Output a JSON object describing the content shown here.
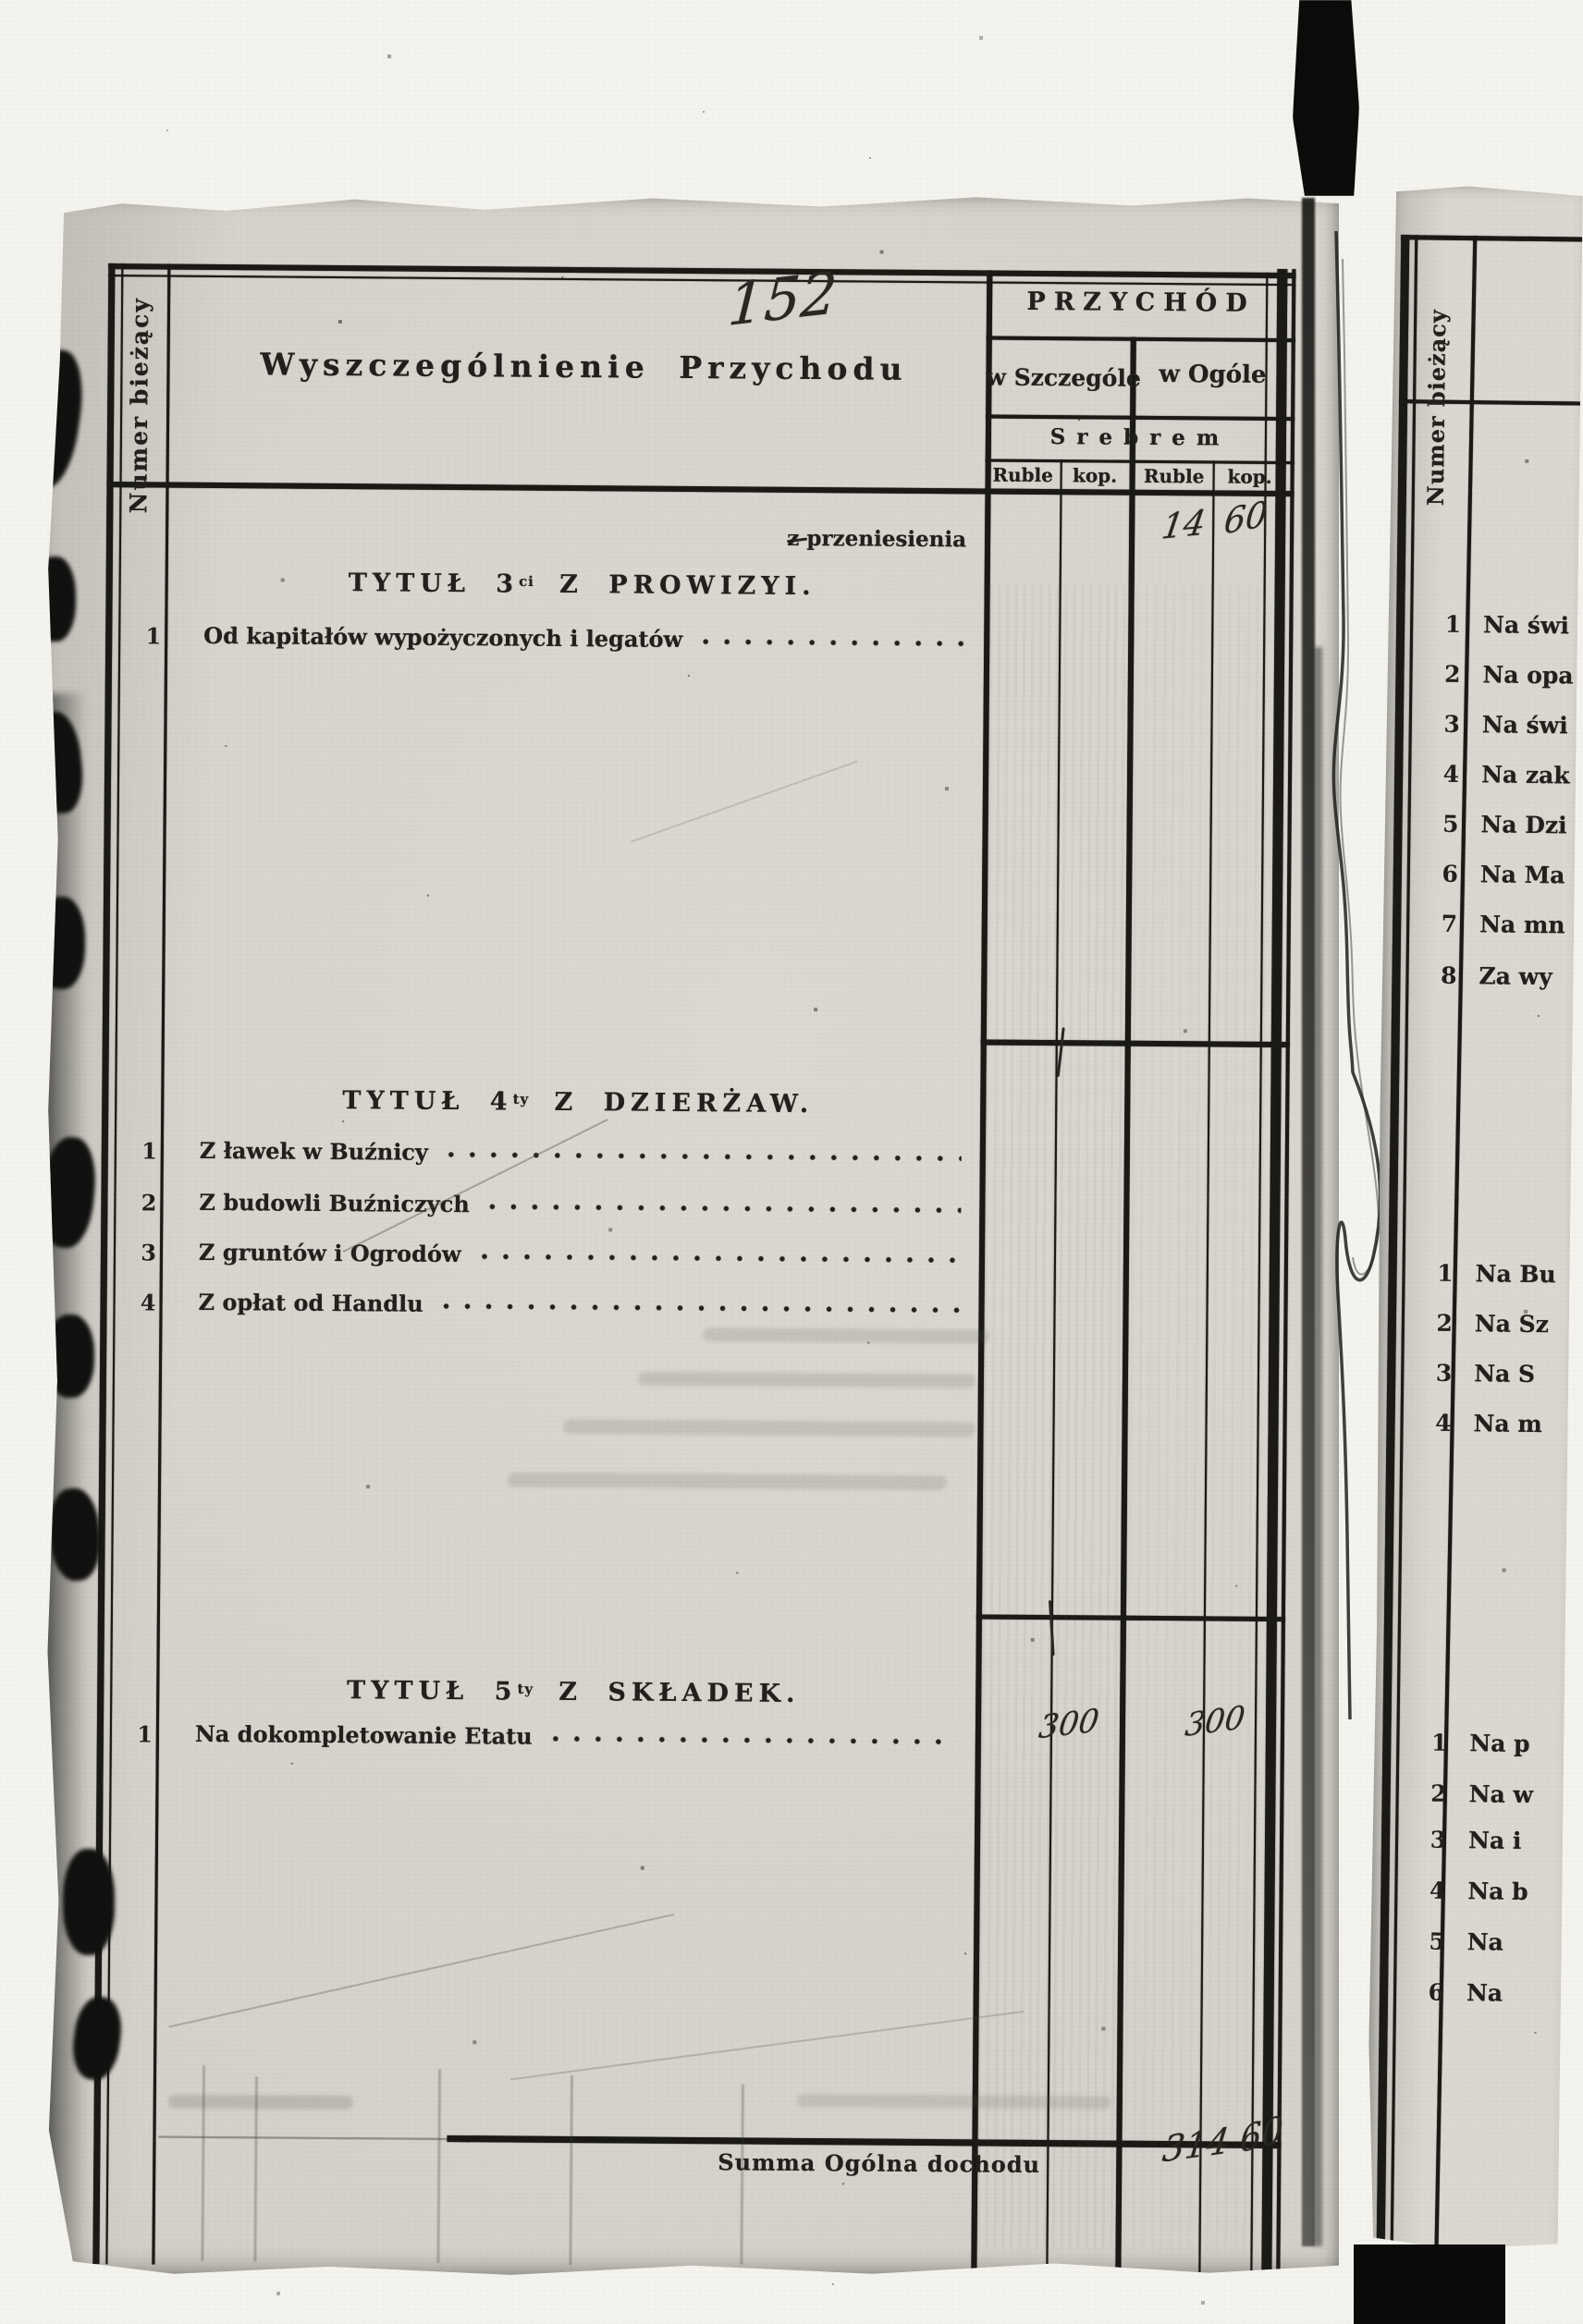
{
  "folio_handwritten": "152",
  "left_page": {
    "row_number_column_label": "Numer bieżący",
    "description_header": "Wyszczególnienie Przychodu",
    "income_header": "PRZYCHÓD",
    "col_in_detail": "w Szczególe",
    "col_in_total": "w Ogóle",
    "currency_row": "Srebrem",
    "units": [
      "Ruble",
      "kop.",
      "Ruble",
      "kop."
    ],
    "carryover_label": "z przeniesienia",
    "carryover_total_ruble": "14",
    "carryover_total_kop": "60",
    "sections": [
      {
        "title_prefix": "TYTUŁ 3",
        "title_sup": "ci",
        "title_rest": "Z PROWIZYI.",
        "items": [
          {
            "num": "1",
            "label": "Od kapitałów wypożyczonych i legatów"
          }
        ]
      },
      {
        "title_prefix": "TYTUŁ 4",
        "title_sup": "ty",
        "title_rest": "Z DZIERŻAW.",
        "items": [
          {
            "num": "1",
            "label": "Z ławek w Buźnicy"
          },
          {
            "num": "2",
            "label": "Z budowli Buźniczych"
          },
          {
            "num": "3",
            "label": "Z gruntów i Ogrodów"
          },
          {
            "num": "4",
            "label": "Z opłat od Handlu"
          }
        ]
      },
      {
        "title_prefix": "TYTUŁ 5",
        "title_sup": "ty",
        "title_rest": "Z SKŁADEK.",
        "items": [
          {
            "num": "1",
            "label": "Na dokompletowanie Etatu",
            "detail_ruble": "300",
            "total_ruble": "300"
          }
        ]
      }
    ],
    "summary_label": "Summa Ogólna dochodu",
    "summary_total_ruble": "314",
    "summary_total_kop": "60"
  },
  "right_page": {
    "row_number_column_label": "Numer bieżący",
    "groups": [
      {
        "items": [
          {
            "num": "1",
            "label": "Na świ"
          },
          {
            "num": "2",
            "label": "Na opa"
          },
          {
            "num": "3",
            "label": "Na świ"
          },
          {
            "num": "4",
            "label": "Na zak"
          },
          {
            "num": "5",
            "label": "Na Dzi"
          },
          {
            "num": "6",
            "label": "Na Ma"
          },
          {
            "num": "7",
            "label": "Na mn"
          },
          {
            "num": "8",
            "label": "Za wy"
          }
        ]
      },
      {
        "items": [
          {
            "num": "1",
            "label": "Na Bu"
          },
          {
            "num": "2",
            "label": "Na Sz"
          },
          {
            "num": "3",
            "label": "Na S"
          },
          {
            "num": "4",
            "label": "Na m"
          }
        ]
      },
      {
        "items": [
          {
            "num": "1",
            "label": "Na p"
          },
          {
            "num": "2",
            "label": "Na w"
          },
          {
            "num": "3",
            "label": "Na i"
          },
          {
            "num": "4",
            "label": "Na b"
          },
          {
            "num": "5",
            "label": "Na"
          },
          {
            "num": "6",
            "label": "Na"
          }
        ]
      }
    ]
  }
}
